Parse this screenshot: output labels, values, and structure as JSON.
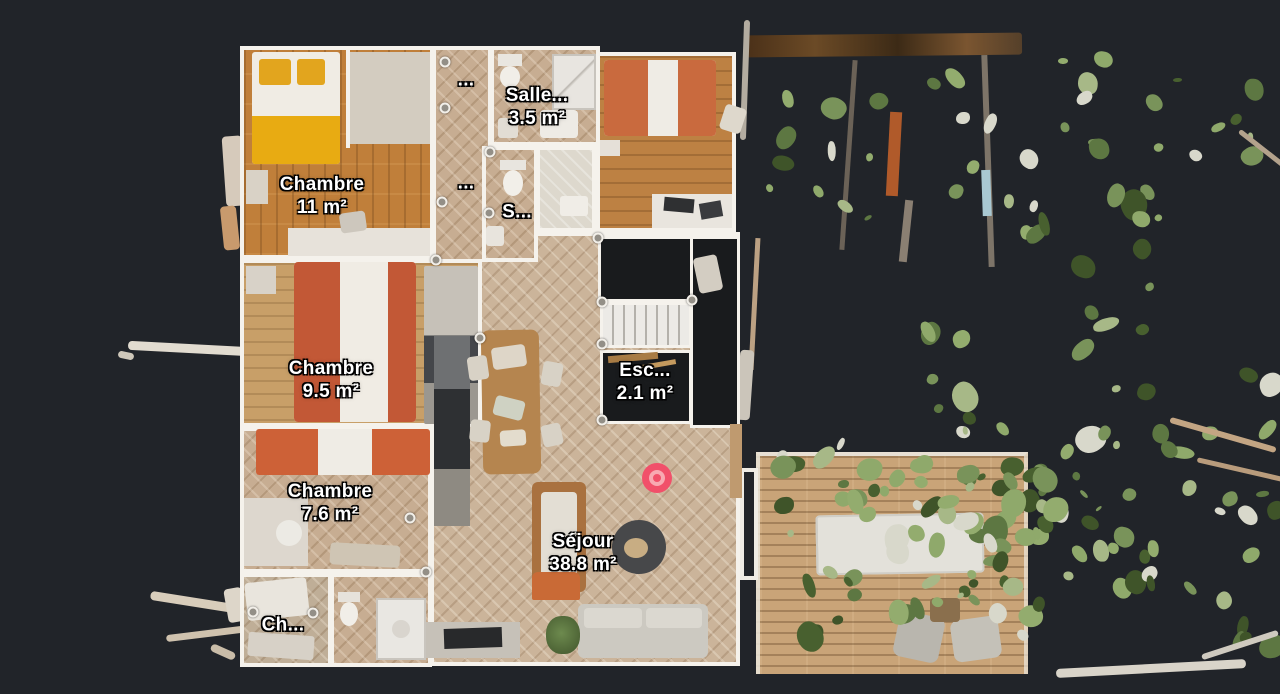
{
  "view": {
    "name": "floorplan-view",
    "level_label": ""
  },
  "colors": {
    "background": "#212429",
    "wall": "#f5f2ec",
    "void": "#191b1d",
    "label_text": "#ffffff",
    "marker": "#f1506a",
    "marker_ring": "#f8a9b2"
  },
  "rooms": {
    "chambre_11": {
      "label": "Chambre",
      "area": "11 m²"
    },
    "chambre_95": {
      "label": "Chambre",
      "area": "9.5 m²"
    },
    "chambre_76": {
      "label": "Chambre",
      "area": "7.6 m²"
    },
    "chambre_petite": {
      "label": "Ch...",
      "area": ""
    },
    "salle_de_bain": {
      "label": "Salle...",
      "area": "3.5 m²"
    },
    "salle_eau": {
      "label": "S...",
      "area": ""
    },
    "escalier": {
      "label": "Esc...",
      "area": "2.1 m²"
    },
    "sejour": {
      "label": "Séjour",
      "area": "38.8 m²"
    },
    "couloir_haut": {
      "label": "...",
      "area": ""
    },
    "couloir_bas": {
      "label": "...",
      "area": ""
    }
  }
}
